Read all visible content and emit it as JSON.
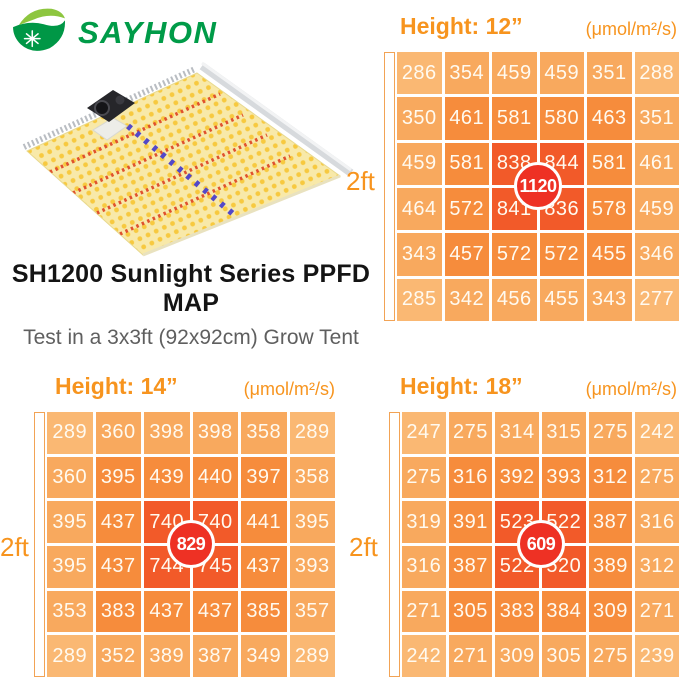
{
  "logo": {
    "brand": "SAYHON"
  },
  "intro": {
    "title": "SH1200 Sunlight Series PPFD MAP",
    "subtitle": "Test in a 3x3ft (92x92cm) Grow Tent"
  },
  "colors": {
    "brand_green": "#009B48",
    "leaf_light_green": "#8DC63F",
    "accent_orange": "#F7941E",
    "cell_text": "#FFFAF0",
    "grid_levels": [
      "#FAB873",
      "#F8A95E",
      "#F68C3C",
      "#F25A29"
    ],
    "peak_circle_red": "#EE3124",
    "led_yellow": "#F7C93F",
    "led_red_stripe": "#E0512E",
    "led_blue": "#5348C8"
  },
  "chart_data": [
    {
      "type": "heatmap",
      "title": "Height: 12”",
      "unit_label": "(μmol/m²/s)",
      "side_label": "2ft",
      "peak": 1120,
      "grid": "6x6",
      "values": [
        [
          286,
          354,
          459,
          459,
          351,
          288
        ],
        [
          350,
          461,
          581,
          580,
          463,
          351
        ],
        [
          459,
          581,
          838,
          844,
          581,
          461
        ],
        [
          464,
          572,
          841,
          836,
          578,
          459
        ],
        [
          343,
          457,
          572,
          572,
          455,
          346
        ],
        [
          285,
          342,
          456,
          455,
          343,
          277
        ]
      ]
    },
    {
      "type": "heatmap",
      "title": "Height: 14”",
      "unit_label": "(μmol/m²/s)",
      "side_label": "2ft",
      "peak": 829,
      "grid": "6x6",
      "values": [
        [
          289,
          360,
          398,
          398,
          358,
          289
        ],
        [
          360,
          395,
          439,
          440,
          397,
          358
        ],
        [
          395,
          437,
          740,
          740,
          441,
          395
        ],
        [
          395,
          437,
          744,
          745,
          437,
          393
        ],
        [
          353,
          383,
          437,
          437,
          385,
          357
        ],
        [
          289,
          352,
          389,
          387,
          349,
          289
        ]
      ]
    },
    {
      "type": "heatmap",
      "title": "Height: 18”",
      "unit_label": "(μmol/m²/s)",
      "side_label": "2ft",
      "peak": 609,
      "grid": "6x6",
      "values": [
        [
          247,
          275,
          314,
          315,
          275,
          242
        ],
        [
          275,
          316,
          392,
          393,
          312,
          275
        ],
        [
          319,
          391,
          523,
          522,
          387,
          316
        ],
        [
          316,
          387,
          522,
          520,
          389,
          312
        ],
        [
          271,
          305,
          383,
          384,
          309,
          271
        ],
        [
          242,
          271,
          309,
          305,
          275,
          239
        ]
      ]
    }
  ]
}
